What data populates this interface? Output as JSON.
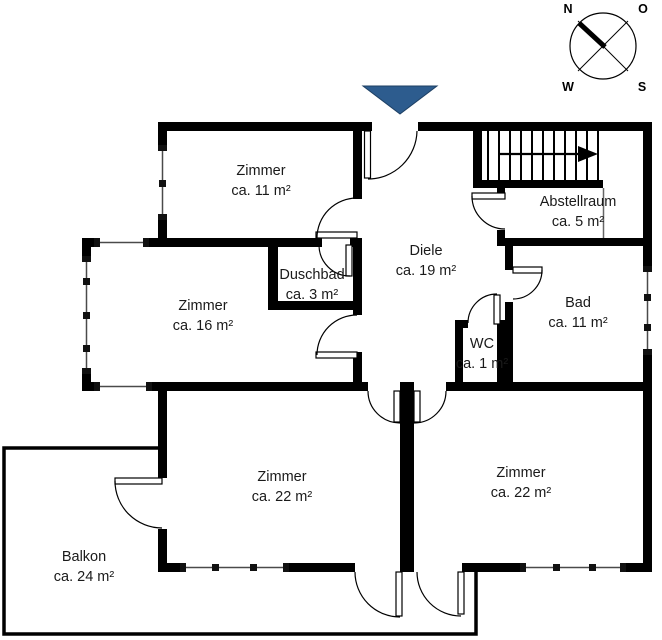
{
  "rooms": {
    "zimmer11": {
      "name": "Zimmer",
      "area": "ca. 11 m²"
    },
    "zimmer16": {
      "name": "Zimmer",
      "area": "ca. 16 m²"
    },
    "duschbad": {
      "name": "Duschbad",
      "area": "ca. 3 m²"
    },
    "diele": {
      "name": "Diele",
      "area": "ca. 19 m²"
    },
    "abstellraum": {
      "name": "Abstellraum",
      "area": "ca. 5 m²"
    },
    "bad": {
      "name": "Bad",
      "area": "ca. 11 m²"
    },
    "wc": {
      "name": "WC",
      "area": "ca. 1 m²"
    },
    "zimmer22_left": {
      "name": "Zimmer",
      "area": "ca. 22 m²"
    },
    "zimmer22_right": {
      "name": "Zimmer",
      "area": "ca. 22 m²"
    },
    "balkon": {
      "name": "Balkon",
      "area": "ca. 24 m²"
    }
  },
  "compass": {
    "north": "N",
    "east": "O",
    "west": "W",
    "south": "S"
  },
  "colors": {
    "wall": "#000000",
    "entrance_marker": "#2d5c8e",
    "window_line": "#4a4a4a"
  }
}
